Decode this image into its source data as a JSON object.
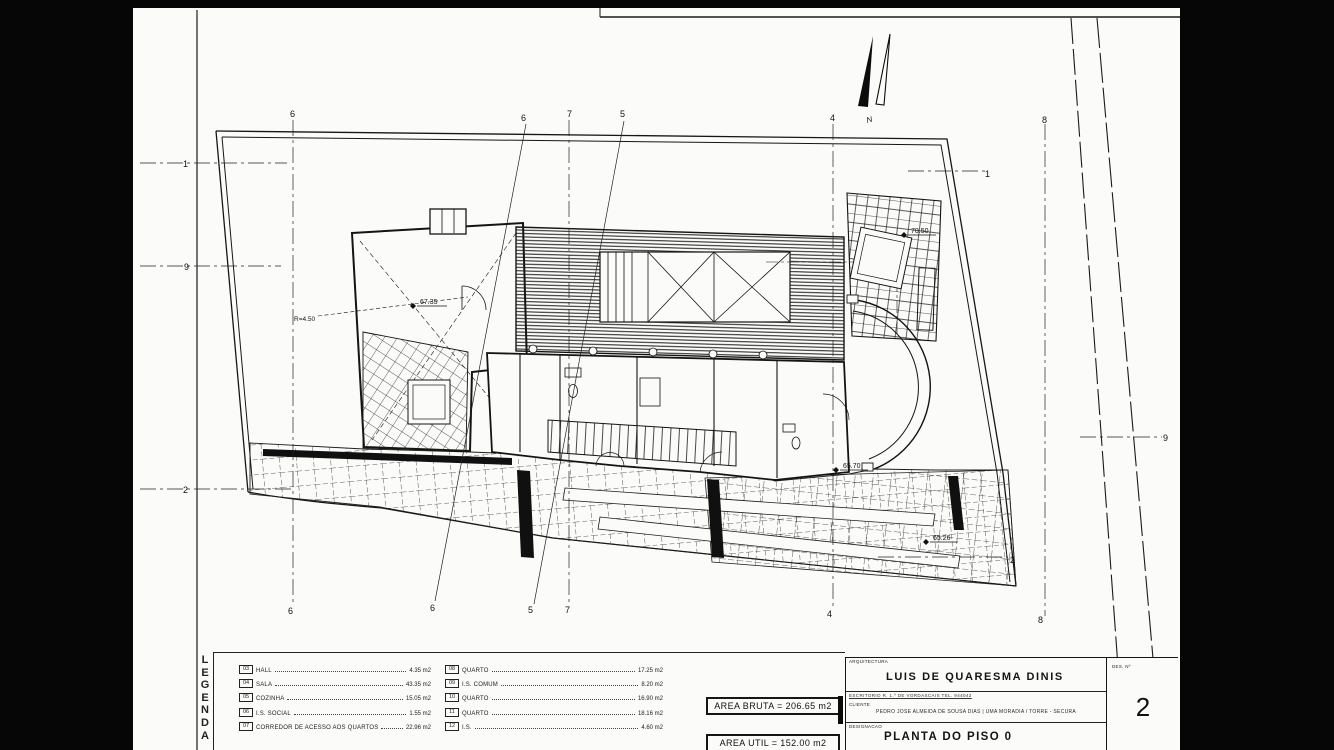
{
  "plan": {
    "grid": {
      "top": [
        "6",
        "6",
        "7",
        "5",
        "4",
        "8"
      ],
      "bottom": [
        "6",
        "6",
        "5",
        "7",
        "4",
        "8"
      ],
      "left": [
        "1",
        "9",
        "2"
      ],
      "right": [
        "1",
        "9",
        "2"
      ]
    },
    "north_label": "N",
    "radius_label": "R=4.50",
    "levels": [
      "67.35",
      "70.50",
      "65.70",
      "65.26"
    ]
  },
  "legend": {
    "letters": [
      "L",
      "E",
      "G",
      "E",
      "N",
      "D",
      "A"
    ],
    "unit": "m2",
    "columns": [
      [
        {
          "num": "03",
          "label": "HALL",
          "area": "4.35 m2"
        },
        {
          "num": "04",
          "label": "SALA",
          "area": "43.35 m2"
        },
        {
          "num": "05",
          "label": "COZINHA",
          "area": "15.05 m2"
        },
        {
          "num": "06",
          "label": "I.S. SOCIAL",
          "area": "1.55 m2"
        },
        {
          "num": "07",
          "label": "CORREDOR DE ACESSO AOS QUARTOS",
          "area": "22.96 m2"
        }
      ],
      [
        {
          "num": "08",
          "label": "QUARTO",
          "area": "17.25 m2"
        },
        {
          "num": "09",
          "label": "I.S. COMUM",
          "area": "8.20 m2"
        },
        {
          "num": "10",
          "label": "QUARTO",
          "area": "16.90 m2"
        },
        {
          "num": "11",
          "label": "QUARTO",
          "area": "18.16 m2"
        },
        {
          "num": "12",
          "label": "I.S.",
          "area": "4.60 m2"
        }
      ]
    ]
  },
  "areas": {
    "bruta": "AREA BRUTA = 206.65 m2",
    "util": "AREA UTIL  = 152.00 m2"
  },
  "titleblock": {
    "section_label": "ARQUITECTURA",
    "architect": "LUIS DE QUARESMA DINIS",
    "office_line": "ESCRITORIO   R. 1.º DE VORDASCAIS   TEL. 944042",
    "client_label": "CLIENTE",
    "client_line": "PEDRO JOSE ALMEIDA DE SOUSA DIAS | UMA MORADIA / TORRE - SECURA",
    "designation_label": "DESIGNACAO",
    "drawing_title": "PLANTA DO PISO 0",
    "number_label": "DES. Nº",
    "sheet_number": "2"
  }
}
